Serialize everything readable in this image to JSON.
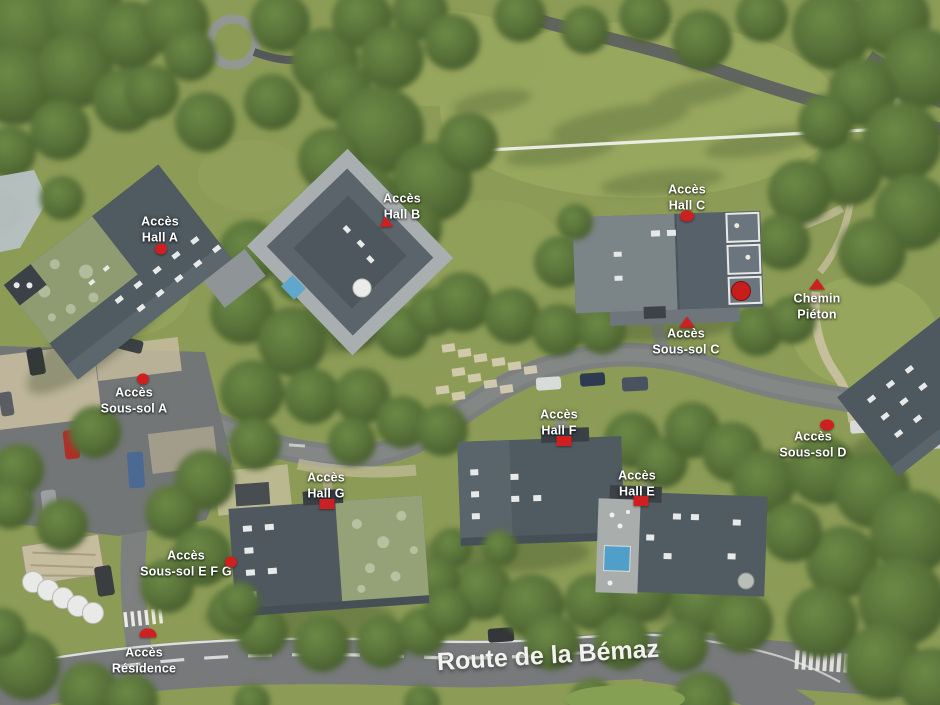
{
  "scene": {
    "kind": "aerial-site-plan",
    "description": "Aerial rendering of a residential complex with access annotations"
  },
  "road": {
    "name": "Route de la Bémaz"
  },
  "labels": [
    {
      "id": "acces-hall-a",
      "text": "Accès\nHall A"
    },
    {
      "id": "acces-hall-b",
      "text": "Accès\nHall B"
    },
    {
      "id": "acces-hall-c",
      "text": "Accès\nHall C"
    },
    {
      "id": "chemin-pieton",
      "text": "Chemin\nPiéton"
    },
    {
      "id": "acces-sous-sol-c",
      "text": "Accès\nSous-sol C"
    },
    {
      "id": "acces-sous-sol-a",
      "text": "Accès\nSous-sol A"
    },
    {
      "id": "acces-hall-f",
      "text": "Accès\nHall F"
    },
    {
      "id": "acces-sous-sol-d",
      "text": "Accès\nSous-sol D"
    },
    {
      "id": "acces-hall-g",
      "text": "Accès\nHall G"
    },
    {
      "id": "acces-hall-e",
      "text": "Accès\nHall E"
    },
    {
      "id": "acces-sous-sol-efg",
      "text": "Accès\nSous-sol E F G"
    },
    {
      "id": "acces-residence",
      "text": "Accès\nRésidence"
    }
  ],
  "colors": {
    "marker_red": "#ce2020",
    "label_text": "#ffffff",
    "grass": "#8c9c56",
    "tree_green": "#4c652f",
    "road_asphalt": "#7d807f",
    "road_bemaz": "#77797b",
    "path_beige": "#c9c0a4",
    "roof_dark_slate": "#4f5a61",
    "roof_moss_green": "#93a077",
    "roof_terrace_grey": "#a9afb0",
    "pool_blue": "#5fa7cb"
  }
}
